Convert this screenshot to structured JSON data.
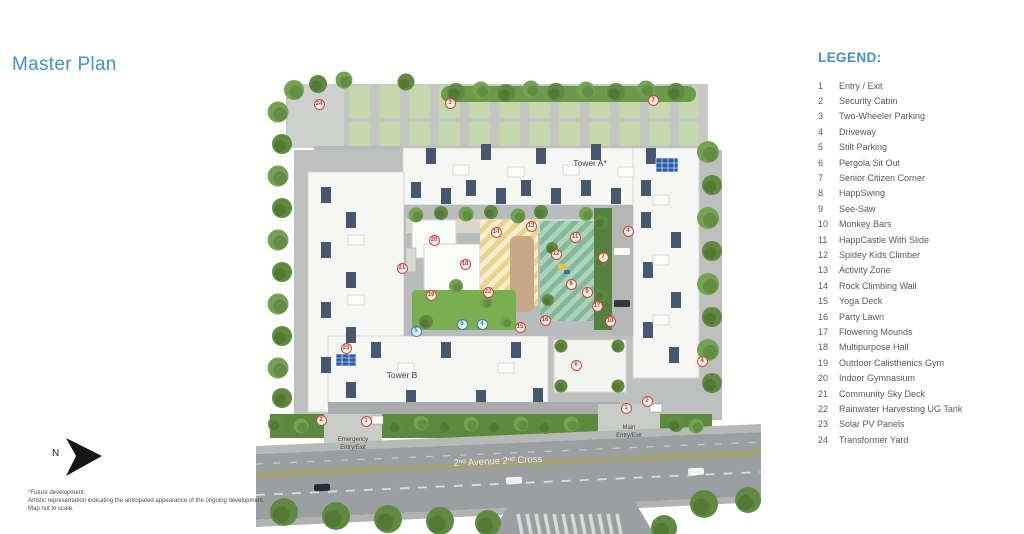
{
  "page": {
    "title": "Master Plan"
  },
  "legend": {
    "heading": "LEGEND:",
    "items": [
      {
        "n": "1",
        "label": "Entry / Exit"
      },
      {
        "n": "2",
        "label": "Security Cabin"
      },
      {
        "n": "3",
        "label": "Two-Wheeler Parking"
      },
      {
        "n": "4",
        "label": "Driveway"
      },
      {
        "n": "5",
        "label": "Stilt Parking"
      },
      {
        "n": "6",
        "label": "Pergola Sit Out"
      },
      {
        "n": "7",
        "label": "Senior Citizen Corner"
      },
      {
        "n": "8",
        "label": "HappSwing"
      },
      {
        "n": "9",
        "label": "See-Saw"
      },
      {
        "n": "10",
        "label": "Monkey Bars"
      },
      {
        "n": "11",
        "label": "HappCastle With Slide"
      },
      {
        "n": "12",
        "label": "Spidey Kids Climber"
      },
      {
        "n": "13",
        "label": "Activity Zone"
      },
      {
        "n": "14",
        "label": "Rock Climbing Wall"
      },
      {
        "n": "15",
        "label": "Yoga Deck"
      },
      {
        "n": "16",
        "label": "Party Lawn"
      },
      {
        "n": "17",
        "label": "Flowering Mounds"
      },
      {
        "n": "18",
        "label": "Multipurpose Hall"
      },
      {
        "n": "19",
        "label": "Outdoor Calisthenics Gym"
      },
      {
        "n": "20",
        "label": "Indoor Gymnasium"
      },
      {
        "n": "21",
        "label": "Community Sky Deck"
      },
      {
        "n": "22",
        "label": "Rainwater Harvesting UG Tank"
      },
      {
        "n": "23",
        "label": "Solar PV Panels"
      },
      {
        "n": "24",
        "label": "Transformer Yard"
      }
    ]
  },
  "plan": {
    "tower_a_label": "Tower A*",
    "tower_b_label": "Tower B",
    "road_label": "2ⁿᵈ Avenue 2ⁿᵈ Cross",
    "gates": {
      "emergency_line1": "Emergency",
      "emergency_line2": "Entry/Exit",
      "main_line1": "Main",
      "main_line2": "Entry/Exit"
    },
    "markers": [
      {
        "x": 63,
        "y": 104,
        "n": "24",
        "color": "red"
      },
      {
        "x": 194,
        "y": 103,
        "n": "3",
        "color": "red"
      },
      {
        "x": 397,
        "y": 100,
        "n": "3",
        "color": "red"
      },
      {
        "x": 90,
        "y": 348,
        "n": "23",
        "color": "red"
      },
      {
        "x": 65,
        "y": 420,
        "n": "2",
        "color": "red"
      },
      {
        "x": 110,
        "y": 421,
        "n": "1",
        "color": "red"
      },
      {
        "x": 370,
        "y": 408,
        "n": "1",
        "color": "red"
      },
      {
        "x": 391,
        "y": 401,
        "n": "2",
        "color": "red"
      },
      {
        "x": 446,
        "y": 361,
        "n": "4",
        "color": "red"
      },
      {
        "x": 178,
        "y": 240,
        "n": "20",
        "color": "red"
      },
      {
        "x": 209,
        "y": 264,
        "n": "18",
        "color": "red"
      },
      {
        "x": 146,
        "y": 268,
        "n": "21",
        "color": "red"
      },
      {
        "x": 175,
        "y": 295,
        "n": "19",
        "color": "red"
      },
      {
        "x": 240,
        "y": 232,
        "n": "14",
        "color": "red"
      },
      {
        "x": 275,
        "y": 226,
        "n": "13",
        "color": "red"
      },
      {
        "x": 300,
        "y": 254,
        "n": "12",
        "color": "red"
      },
      {
        "x": 319,
        "y": 237,
        "n": "11",
        "color": "red"
      },
      {
        "x": 315,
        "y": 284,
        "n": "8",
        "color": "red"
      },
      {
        "x": 331,
        "y": 292,
        "n": "9",
        "color": "red"
      },
      {
        "x": 341,
        "y": 306,
        "n": "17",
        "color": "red"
      },
      {
        "x": 347,
        "y": 257,
        "n": "7",
        "color": "red"
      },
      {
        "x": 372,
        "y": 231,
        "n": "4",
        "color": "red"
      },
      {
        "x": 289,
        "y": 320,
        "n": "16",
        "color": "red"
      },
      {
        "x": 264,
        "y": 327,
        "n": "15",
        "color": "red"
      },
      {
        "x": 354,
        "y": 321,
        "n": "10",
        "color": "red"
      },
      {
        "x": 232,
        "y": 292,
        "n": "22",
        "color": "red"
      },
      {
        "x": 320,
        "y": 365,
        "n": "6",
        "color": "red"
      },
      {
        "x": 160,
        "y": 331,
        "n": "5",
        "color": "blue"
      },
      {
        "x": 206,
        "y": 324,
        "n": "5",
        "color": "blue"
      },
      {
        "x": 226,
        "y": 324,
        "n": "4",
        "color": "blue"
      }
    ]
  },
  "compass": {
    "label": "N"
  },
  "footnote": {
    "line1": "*Future development.",
    "line2": "Artistic representation indicating the anticipated appearance of the ongoing development.",
    "line3": "Map not to scale."
  },
  "colors": {
    "accent_blue": "#4191c5",
    "marker_red": "#d0453c",
    "marker_blue": "#3c7dbf"
  }
}
